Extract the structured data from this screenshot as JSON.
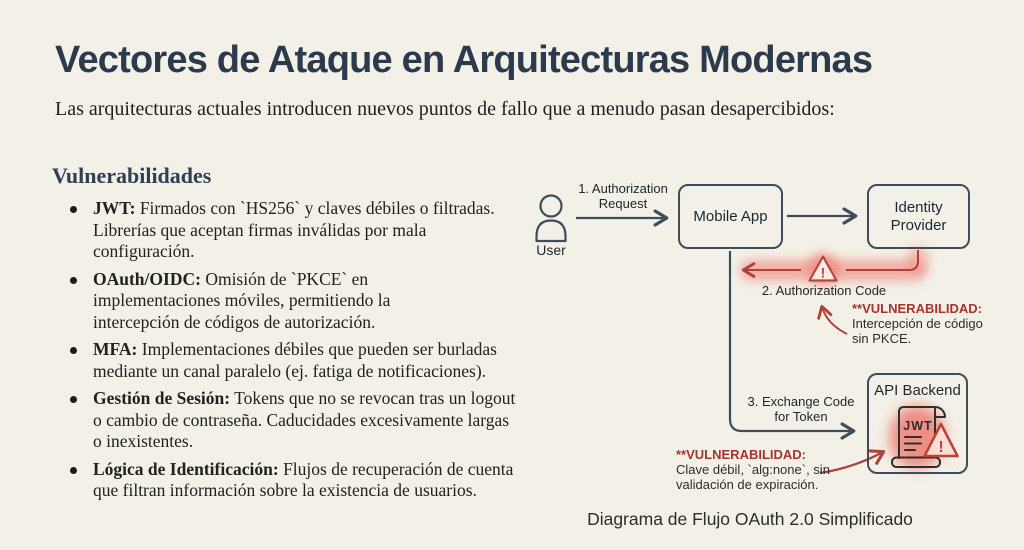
{
  "page": {
    "title": "Vectores de Ataque en Arquitecturas Modernas",
    "subtitle": "Las arquitecturas actuales introducen nuevos puntos de fallo que a menudo pasan desapercibidos:"
  },
  "vulnerabilities": {
    "heading": "Vulnerabilidades",
    "items": [
      {
        "term": "JWT:",
        "text": "Firmados con `HS256` y claves débiles o filtradas. Librerías que aceptan firmas inválidas por mala configuración."
      },
      {
        "term": "OAuth/OIDC:",
        "text": "Omisión de `PKCE` en implementaciones móviles, permitiendo la intercepción de códigos de autorización."
      },
      {
        "term": "MFA:",
        "text": "Implementaciones débiles que pueden ser burladas mediante un canal paralelo (ej. fatiga de notificaciones)."
      },
      {
        "term": "Gestión de Sesión:",
        "text": "Tokens que no se revocan tras un logout o cambio de contraseña. Caducidades excesivamente largas o inexistentes."
      },
      {
        "term": "Lógica de Identificación:",
        "text": "Flujos de recuperación de cuenta que filtran información sobre la existencia de usuarios."
      }
    ]
  },
  "diagram": {
    "caption": "Diagrama de Flujo OAuth 2.0 Simplificado",
    "nodes": {
      "user": "User",
      "mobile_app": "Mobile App",
      "identity_provider": "Identity Provider",
      "api_backend": "API Backend"
    },
    "flows": {
      "step1": "1. Authorization Request",
      "step2": "2. Authorization Code",
      "step3": "3. Exchange Code for Token"
    },
    "jwt_icon_label": "JWT",
    "warning_glyph": "!",
    "annotations": [
      {
        "title": "**VULNERABILIDAD:",
        "lines": [
          "Intercepción de código",
          "sin PKCE."
        ]
      },
      {
        "title": "**VULNERABILIDAD:",
        "lines": [
          "Clave débil, `alg:none`, sin",
          "validación de expiración."
        ]
      }
    ],
    "colors": {
      "background": "#f3f0e7",
      "stroke": "#3f4c59",
      "alert_red": "#b0413a",
      "glow_red": "#ef8379"
    }
  }
}
